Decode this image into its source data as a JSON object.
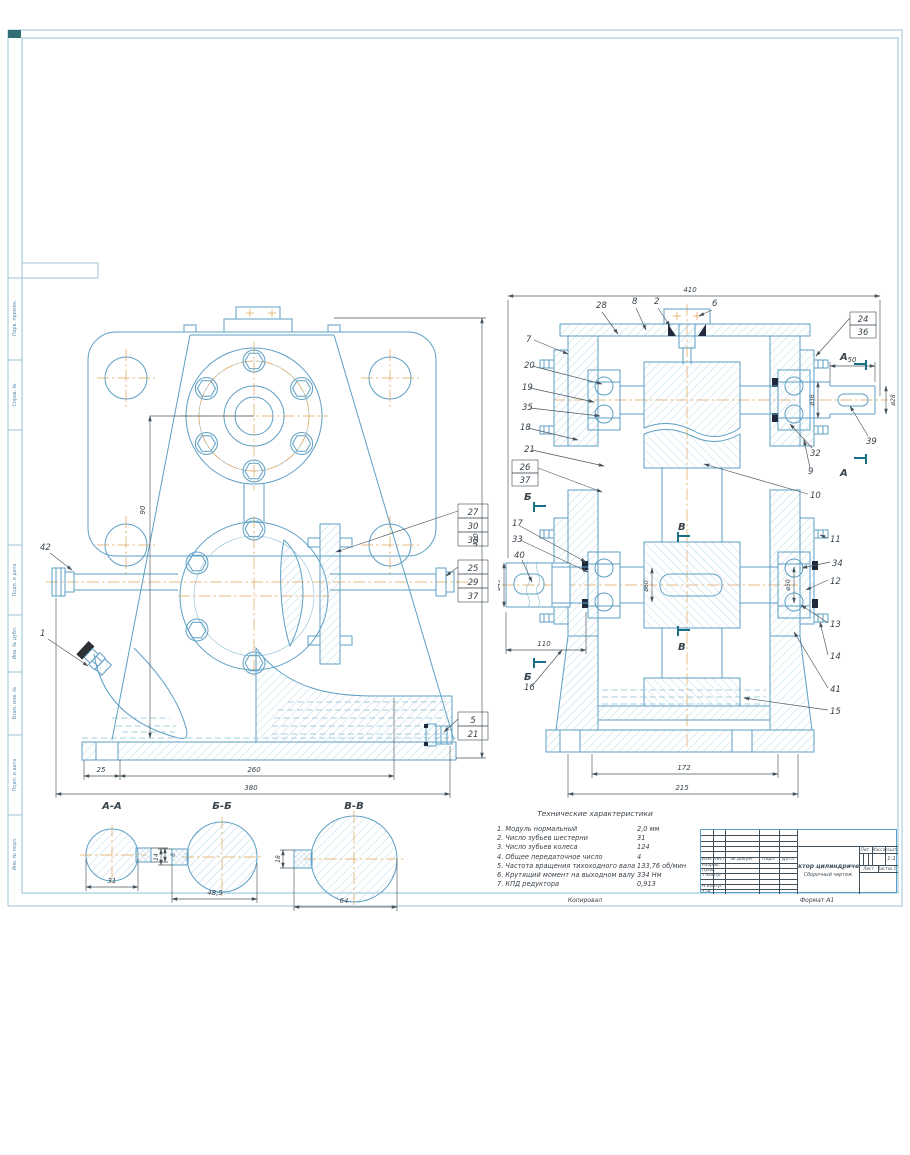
{
  "page": {
    "copied": "Копировал",
    "format": "Формат А1"
  },
  "edge_labels": [
    "Перв. примен.",
    "Справ. №",
    "Подп. и дата",
    "Инв. № дубл.",
    "Взам. инв. №",
    "Подп. и дата",
    "Инв. № подл."
  ],
  "front": {
    "callout_42": "42",
    "callout_1": "1",
    "stack_a": [
      "27",
      "30",
      "38"
    ],
    "stack_b": [
      "25",
      "29",
      "37"
    ],
    "stack_c": [
      "5",
      "21"
    ],
    "dim_25": "25",
    "dim_260": "260",
    "dim_380": "380",
    "dim_410": "410",
    "dim_90": "90"
  },
  "section": {
    "dim_410": "410",
    "dim_50": "50",
    "dim_d36": "ø36",
    "dim_d28": "ø28",
    "dim_d45": "ø45",
    "dim_d60": "ø60",
    "dim_d50": "ø50",
    "dim_110": "110",
    "dim_172": "172",
    "dim_215": "215",
    "callout_39": "39",
    "top": [
      "28",
      "8",
      "2",
      "6"
    ],
    "left": [
      "7",
      "20",
      "19",
      "35",
      "18",
      "21",
      "26",
      "37",
      "17",
      "33",
      "40",
      "16"
    ],
    "right": [
      "24",
      "36",
      "32",
      "9",
      "10",
      "11",
      "34",
      "12",
      "13",
      "14",
      "41",
      "15"
    ],
    "mark_a": "А",
    "mark_b": "Б",
    "mark_v": "В"
  },
  "cuts": {
    "aa": {
      "t": "А-А",
      "w": "31",
      "k": "8"
    },
    "bb": {
      "t": "Б-Б",
      "w": "48,5",
      "k": "14"
    },
    "vv": {
      "t": "В-В",
      "w": "64",
      "k": "18"
    }
  },
  "specs": {
    "title": "Технические характеристики",
    "items": [
      {
        "label": "1. Модуль нормальный",
        "value": "2,0 мм"
      },
      {
        "label": "2. Число зубьев шестерни",
        "value": "31"
      },
      {
        "label": "3. Число зубьев колеса",
        "value": "124"
      },
      {
        "label": "4. Общее передаточное число",
        "value": "4"
      },
      {
        "label": "5. Частота вращения тихоходного вала",
        "value": "133,76 об/мин"
      },
      {
        "label": "6. Крутящий момент на выходном валу",
        "value": "334 Нм"
      },
      {
        "label": "7. КПД редуктора",
        "value": "0,913"
      }
    ]
  },
  "tb": {
    "title": "Редуктор цилиндрический",
    "subtitle": "Сборочный чертеж",
    "h": [
      "Изм.",
      "Лист",
      "№ докум.",
      "Подп.",
      "Дата"
    ],
    "r1": "Разраб.",
    "r2": "Пров.",
    "r3": "Т.контр.",
    "r4": "Н.контр.",
    "r5": "Утв.",
    "lit": "Лит.",
    "mass": "Масса",
    "scale": "Масштаб",
    "scale_v": "1:1",
    "sheet": "Лист",
    "sheets": "Листов",
    "sheets_v": "1"
  }
}
